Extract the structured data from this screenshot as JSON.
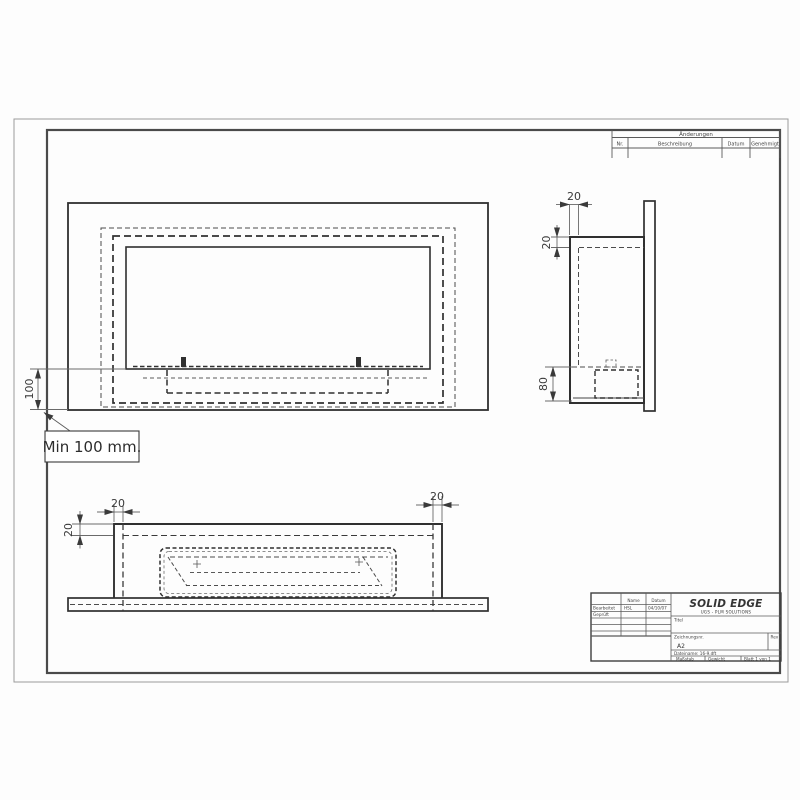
{
  "colors": {
    "line": "#303030",
    "dim": "#6a6a6a",
    "border": "#4a4a4a"
  },
  "revision_table": {
    "title": "Änderungen",
    "col_nr": "Nr.",
    "col_desc": "Beschreibung",
    "col_date": "Datum",
    "col_appr": "Genehmigt"
  },
  "note": {
    "text": "Min 100 mm."
  },
  "dims": {
    "front_min_height": "100",
    "side_front_wall": "20",
    "side_top_wall": "20",
    "side_burner_box": "80",
    "bottom_top_wall": "20",
    "bottom_left_wall": "20",
    "bottom_right_wall": "20"
  },
  "title_block": {
    "col_name": "Name",
    "col_date": "Datum",
    "row_drawn_label": "Bearbeitet",
    "row_drawn_name": "HSL",
    "row_drawn_date": "04/10/07",
    "row_checked_label": "Geprüft",
    "logo": "SOLID EDGE",
    "logo_sub": "UGS - PLM SOLUTIONS",
    "title_label": "Titel",
    "drawing_no_label": "Zeichnungsnr.",
    "drawing_no_value": "A2",
    "rev_label": "Rev",
    "filename": "Dateiname: 16-9.dft",
    "scale_label": "Maßstab",
    "weight_label": "Gewicht",
    "sheet_label": "Blatt 1 von 1"
  }
}
